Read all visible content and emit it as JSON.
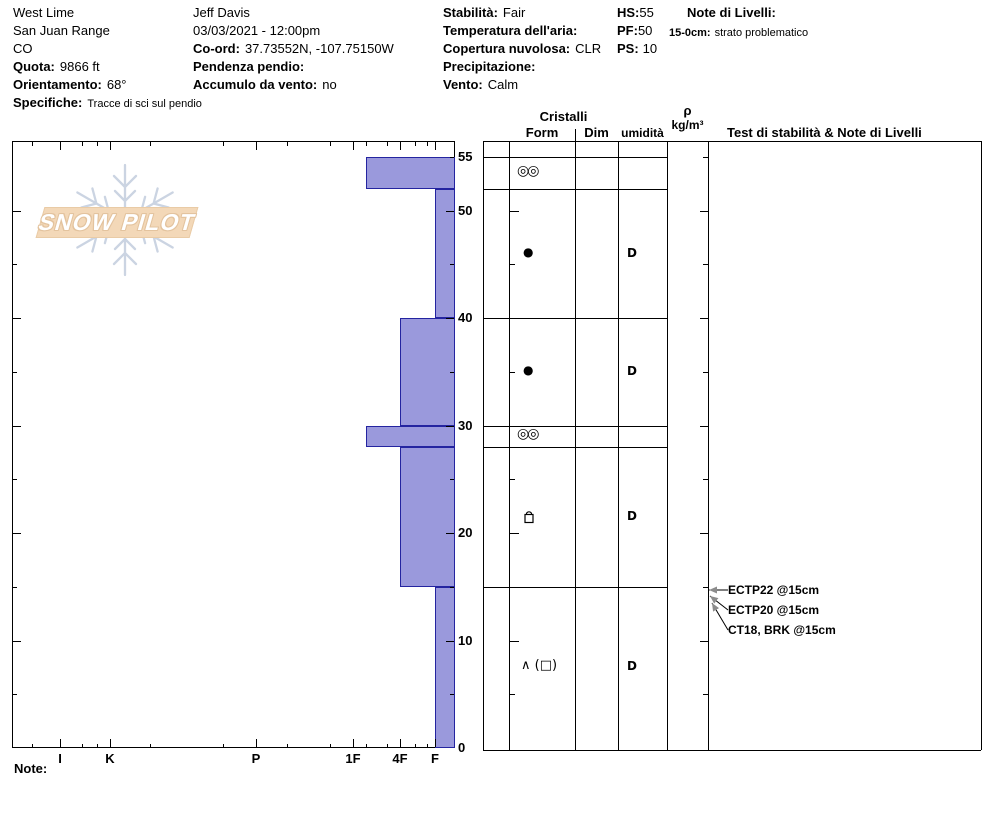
{
  "header": {
    "location": {
      "name": "West Lime",
      "range": "San Juan Range",
      "state": "CO",
      "elevation_label": "Quota:",
      "elevation": "9866 ft",
      "aspect_label": "Orientamento:",
      "aspect": "68°",
      "comments_label": "Specifiche:",
      "comments": "Tracce di sci sul pendio"
    },
    "observer": {
      "name": "Jeff Davis",
      "datetime": "03/03/2021 - 12:00pm",
      "coord_label": "Co-ord:",
      "coord": "37.73552N, -107.75150W",
      "slope_label": "Pendenza pendio:",
      "slope": "",
      "windload_label": "Accumulo da vento:",
      "windload": "no"
    },
    "conditions": {
      "stability_label": "Stabilità:",
      "stability": "Fair",
      "airtemp_label": "Temperatura dell'aria:",
      "airtemp": "",
      "sky_label": "Copertura nuvolosa:",
      "sky": "CLR",
      "precip_label": "Precipitazione:",
      "precip": "",
      "wind_label": "Vento:",
      "wind": "Calm"
    },
    "depths": {
      "hs_label": "HS:",
      "hs": "55",
      "pf_label": "PF:",
      "pf": "50",
      "ps_label": "PS:",
      "ps": "10"
    },
    "notes": {
      "label": "Note di Livelli:",
      "entry_depth": "15-0cm:",
      "entry_text": "strato problematico"
    }
  },
  "logo_text": "SNOW PILOT",
  "panel_headers": {
    "cristalli": "Cristalli",
    "form": "Form",
    "dim": "Dim",
    "humidity": "umidità",
    "rho": "ρ",
    "rho_units": "kg/m³",
    "tests": "Test di stabilità & Note di Livelli"
  },
  "footer_note_label": "Note:",
  "colors": {
    "bar_fill": "#9a99dc",
    "bar_border": "#2424a0",
    "logo_band": "#f3d8b8",
    "snowflake": "#cbd4e2",
    "arrow_head": "#8c8c8c"
  },
  "chart_data": {
    "type": "bar",
    "title": "Snow pit hardness profile",
    "xlabel": "hand hardness",
    "ylabel": "depth (cm)",
    "x_categories": [
      "I",
      "K",
      "P",
      "1F",
      "4F",
      "F"
    ],
    "y_ticks": [
      55,
      50,
      40,
      30,
      20,
      10,
      0
    ],
    "ylim": [
      0,
      56.5
    ],
    "grid": false,
    "layers": [
      {
        "top_cm": 55,
        "bottom_cm": 52,
        "hardness": "1F-",
        "grain_form": "◎◎",
        "grain_dim": "",
        "moisture": ""
      },
      {
        "top_cm": 52,
        "bottom_cm": 40,
        "hardness": "F",
        "grain_form": "●",
        "grain_dim": "",
        "moisture": "D"
      },
      {
        "top_cm": 40,
        "bottom_cm": 30,
        "hardness": "4F",
        "grain_form": "●",
        "grain_dim": "",
        "moisture": "D"
      },
      {
        "top_cm": 30,
        "bottom_cm": 28,
        "hardness": "1F-",
        "grain_form": "◎◎",
        "grain_dim": "",
        "moisture": ""
      },
      {
        "top_cm": 28,
        "bottom_cm": 15,
        "hardness": "4F",
        "grain_form": "FCxr",
        "grain_dim": "",
        "moisture": "D"
      },
      {
        "top_cm": 15,
        "bottom_cm": 0,
        "hardness": "F",
        "grain_form": "∧ (□)",
        "grain_dim": "",
        "moisture": "D"
      }
    ],
    "stability_tests": [
      {
        "label": "ECTP22 @15cm",
        "depth_cm": 15
      },
      {
        "label": "ECTP20 @15cm",
        "depth_cm": 15
      },
      {
        "label": "CT18, BRK @15cm",
        "depth_cm": 15
      }
    ]
  }
}
